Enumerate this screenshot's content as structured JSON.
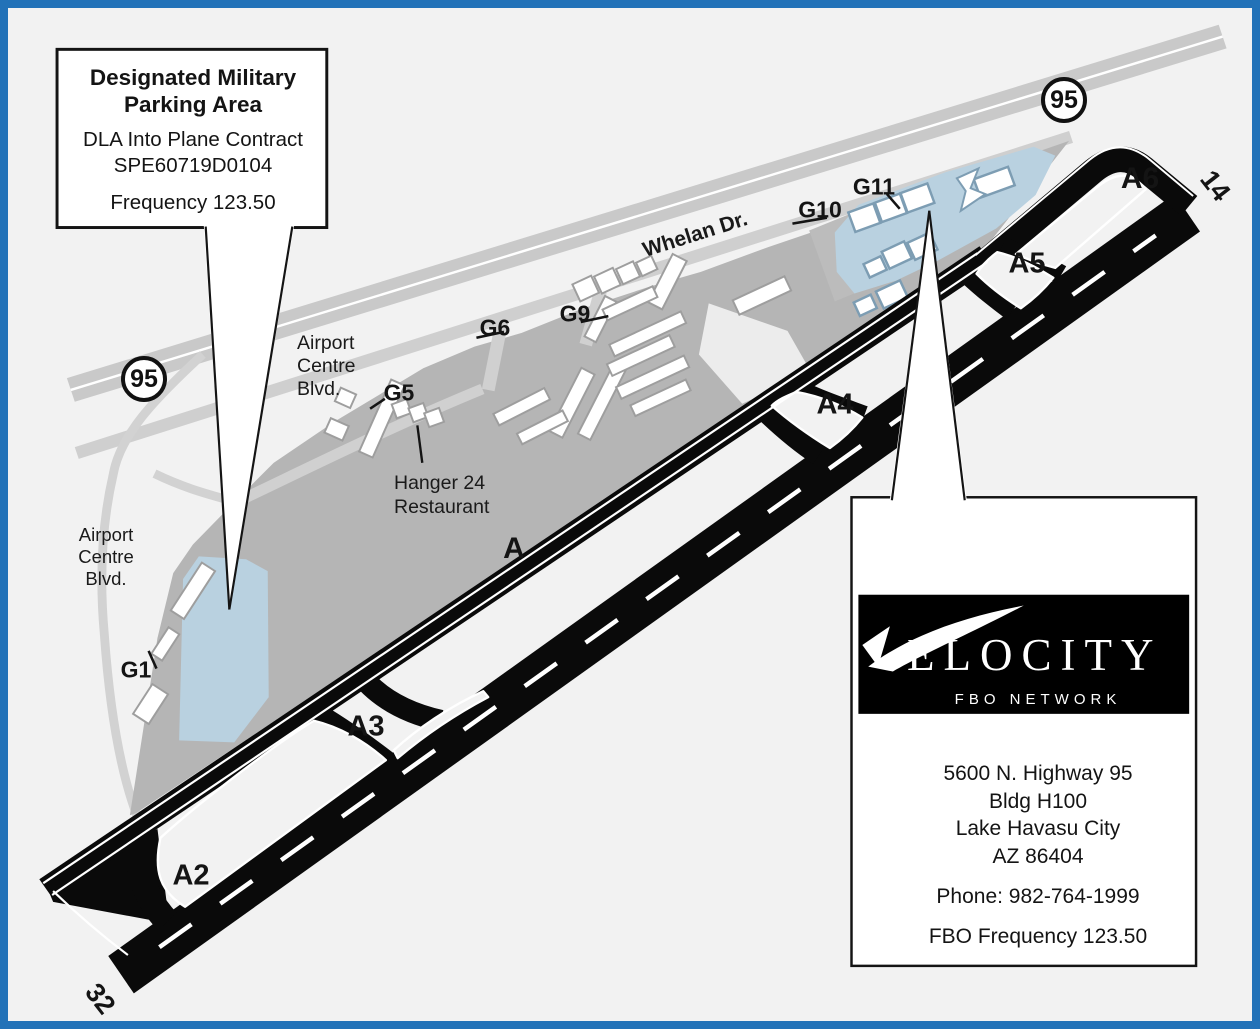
{
  "highway_shield": "95",
  "runway": {
    "end_14": "14",
    "end_32": "32"
  },
  "taxiways": {
    "a": "A",
    "a2": "A2",
    "a3": "A3",
    "a4": "A4",
    "a5": "A5",
    "a6": "A6"
  },
  "gates": {
    "g1": "G1",
    "g5": "G5",
    "g6": "G6",
    "g9": "G9",
    "g10": "G10",
    "g11": "G11"
  },
  "roads": {
    "whelan": "Whelan Dr.",
    "airport_centre_blvd": [
      "Airport",
      "Centre",
      "Blvd."
    ]
  },
  "poi": {
    "hanger24": [
      "Hanger 24",
      "Restaurant"
    ]
  },
  "military_callout": {
    "title": [
      "Designated Military",
      "Parking Area"
    ],
    "contract": [
      "DLA Into Plane Contract",
      "SPE60719D0104"
    ],
    "frequency": "Frequency 123.50"
  },
  "fbo_callout": {
    "logo_word": "ELOCITY",
    "logo_tagline": "FBO NETWORK",
    "address": [
      "5600 N. Highway 95",
      "Bldg H100",
      "Lake Havasu City",
      "AZ 86404"
    ],
    "phone": "Phone: 982-764-1999",
    "frequency": "FBO Frequency 123.50"
  },
  "colors": {
    "frame_border": "#2272b8",
    "background": "#f2f2f2",
    "apron": "#b5b5b5",
    "road": "#c9c9c9",
    "blue_area": "#b9d1e0",
    "blue_outline": "#7d9db3",
    "pavement_black": "#0a0a0a"
  }
}
